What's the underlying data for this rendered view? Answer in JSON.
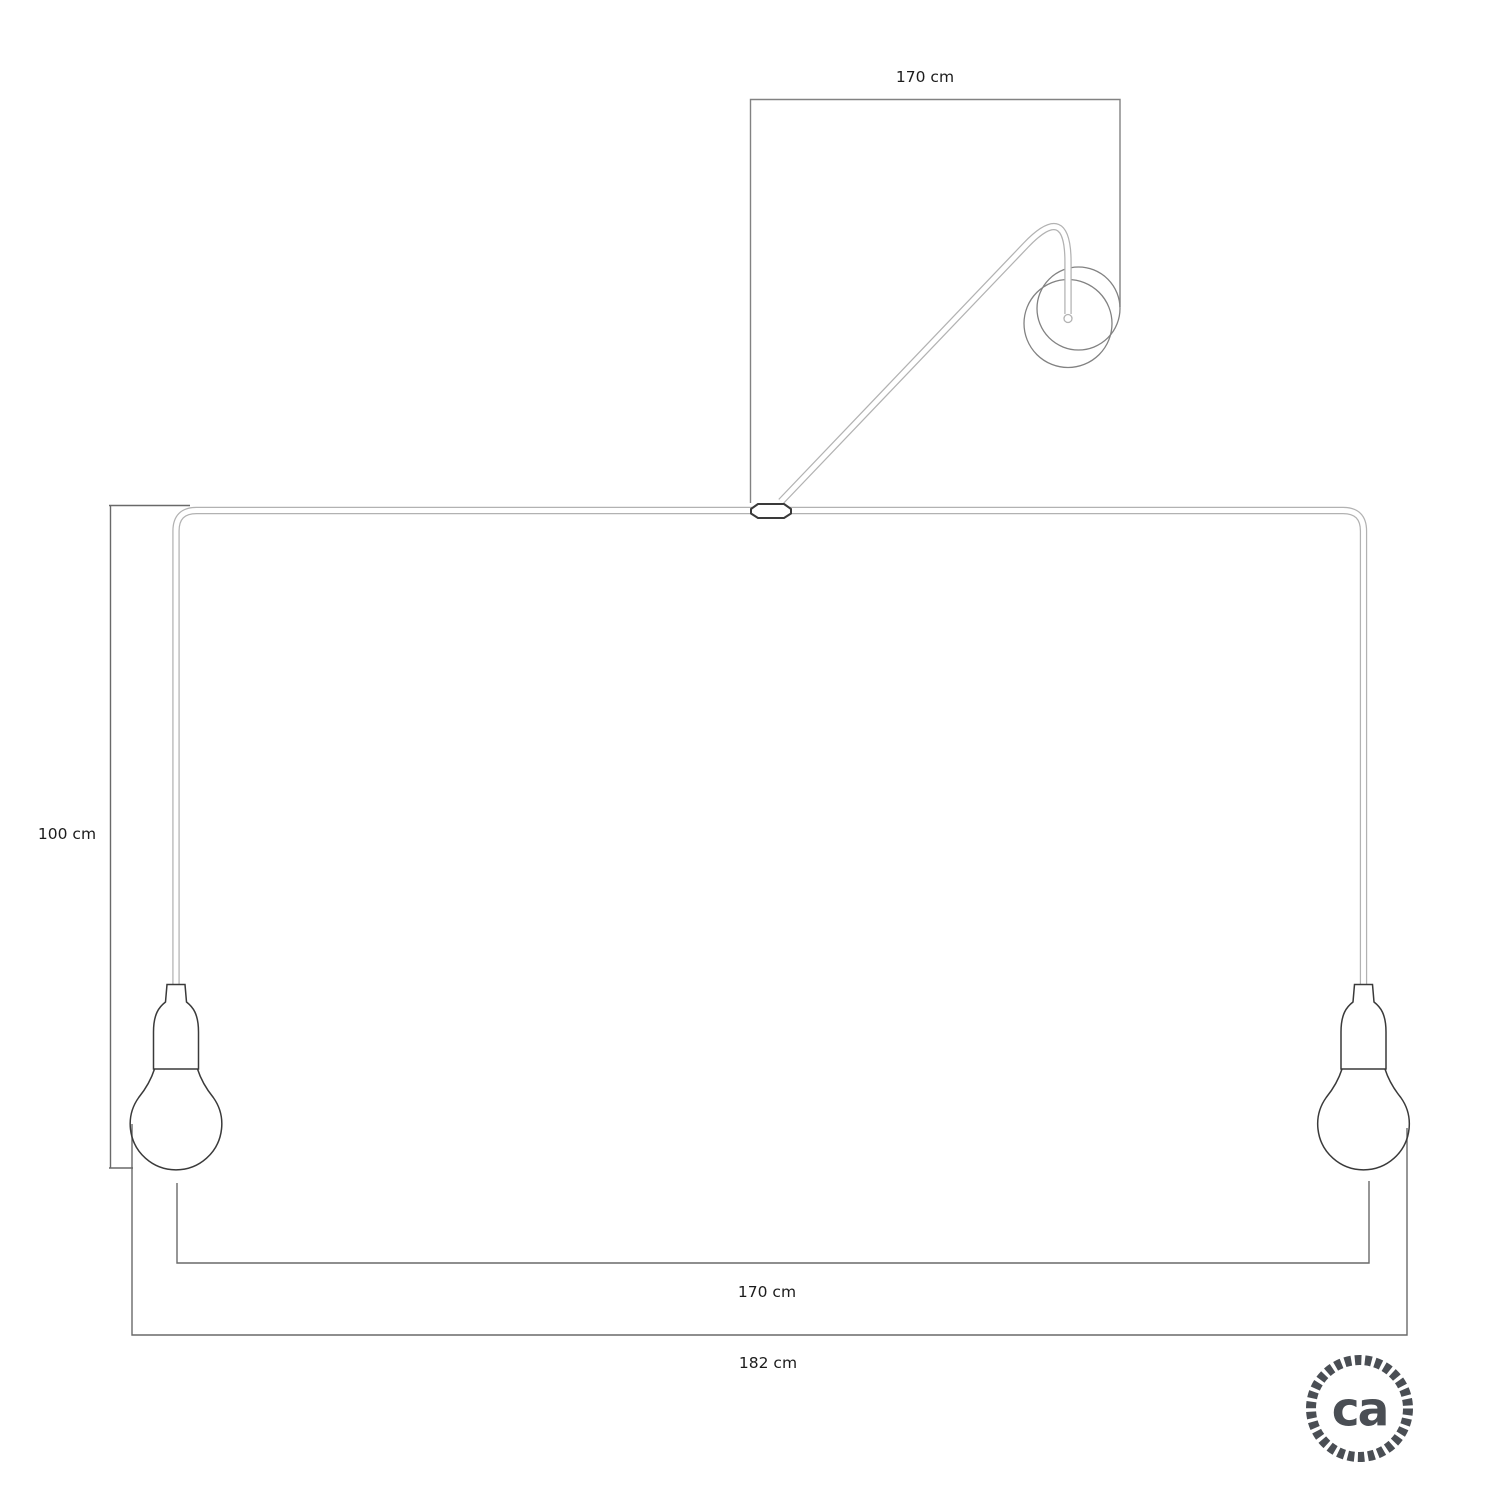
{
  "dimension_labels": {
    "top_cable_length": "170 cm",
    "drop_height": "100 cm",
    "inner_span": "170 cm",
    "outer_span": "182 cm"
  },
  "logo": {
    "text": "ca"
  },
  "colors": {
    "outline": "#3a3a3a",
    "cable": "#b2b2b2",
    "frame": "#828282",
    "dim": "#696969",
    "label": "#1c1c1c",
    "logo": "#4a4e54"
  }
}
